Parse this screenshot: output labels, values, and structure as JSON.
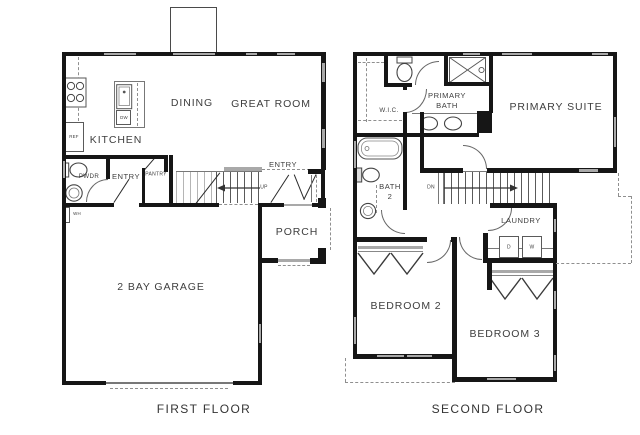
{
  "colors": {
    "wall": "#161616",
    "window": "#a9a9a9",
    "text": "#3e3e3e",
    "background": "#ffffff"
  },
  "first_floor": {
    "title": "FIRST FLOOR",
    "rooms": {
      "kitchen": "KITCHEN",
      "dining": "DINING",
      "great_room": "GREAT ROOM",
      "powder": "PWDR",
      "entry_hall": "ENTRY",
      "pantry": "PANTRY",
      "entry_front": "ENTRY",
      "porch": "PORCH",
      "garage": "2 BAY GARAGE"
    },
    "fixtures": {
      "refrigerator": "REF",
      "dishwasher": "DW",
      "water_heater": "WH"
    },
    "stairs": {
      "direction": "UP"
    }
  },
  "second_floor": {
    "title": "SECOND FLOOR",
    "rooms": {
      "wic": "W.I.C.",
      "primary_bath_line1": "PRIMARY",
      "primary_bath_line2": "BATH",
      "primary_suite": "PRIMARY SUITE",
      "bath2_line1": "BATH",
      "bath2_line2": "2",
      "laundry": "LAUNDRY",
      "bedroom2": "BEDROOM 2",
      "bedroom3": "BEDROOM 3"
    },
    "fixtures": {
      "dryer": "D",
      "washer": "W"
    },
    "stairs": {
      "direction": "DN"
    }
  }
}
